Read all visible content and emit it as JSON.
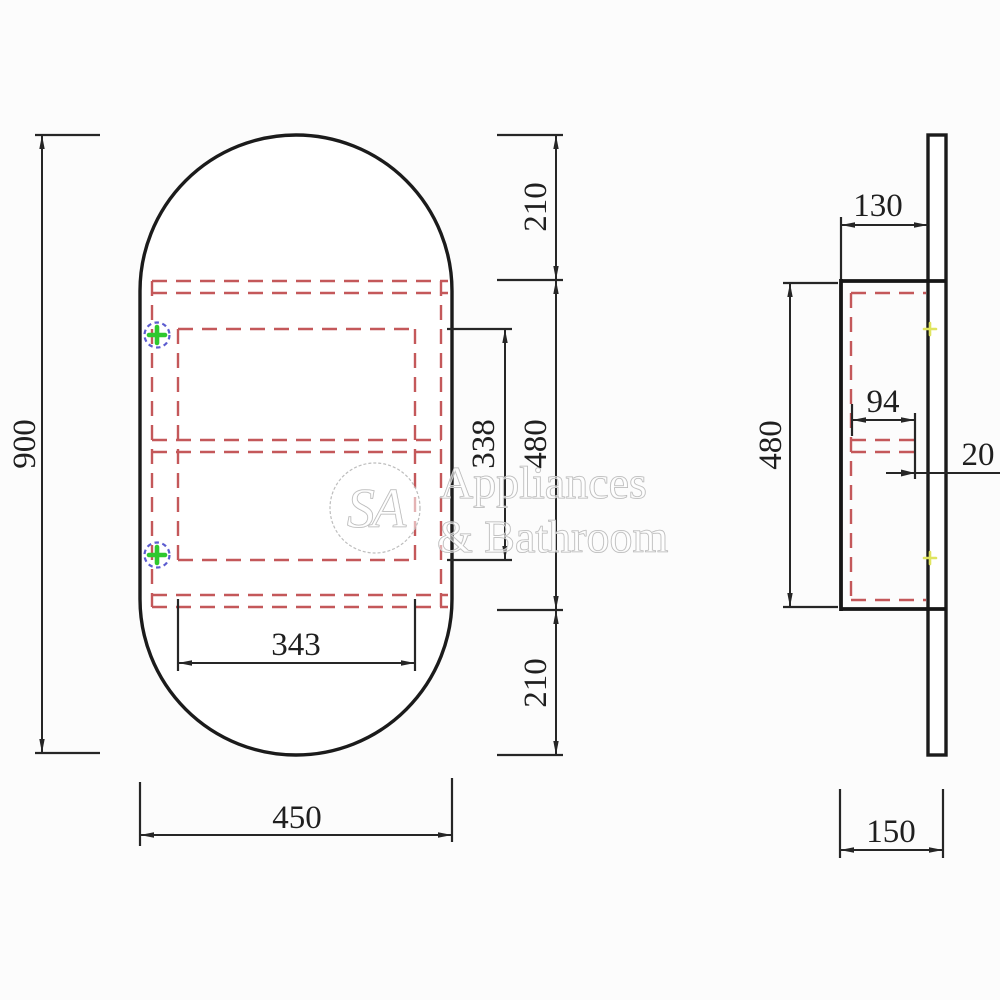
{
  "watermark": {
    "monogram": "SA",
    "line1": "Appliances",
    "line2": "& Bathroom"
  },
  "front_view": {
    "dim_overall_height": "900",
    "dim_top_offset": "210",
    "dim_cabinet_height": "480",
    "dim_bottom_offset": "210",
    "dim_opening_height": "338",
    "dim_opening_width": "343",
    "dim_overall_width": "450"
  },
  "side_view": {
    "dim_depth": "130",
    "dim_cabinet_height": "480",
    "dim_shelf_depth": "94",
    "dim_panel_thickness": "20",
    "dim_overall_depth": "150"
  },
  "colors": {
    "solid_line": "#1b1b1b",
    "hidden_line": "#c4585a",
    "dimension_line": "#262626",
    "marker_green": "#2ec82e",
    "marker_blue": "#5c5cd0",
    "marker_yellow": "#dfe45f",
    "watermark_gray": "#b0b0b0"
  }
}
